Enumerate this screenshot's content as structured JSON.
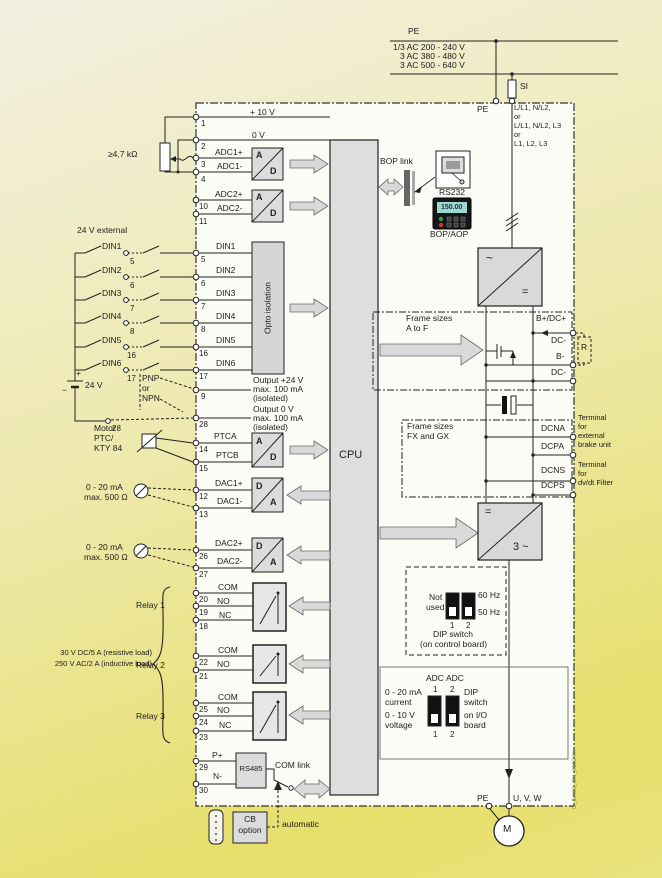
{
  "colors": {
    "bg_top": "#f2f0e2",
    "bg_bottom": "#e6df6b",
    "panel": "#fcfcf7",
    "box_gray": "#dcdcdc",
    "display_teal": "#9fd8d2",
    "led_green": "#35a043",
    "led_red": "#cf3333"
  },
  "mains": {
    "pe": "PE",
    "v1": "1/3 AC 200 - 240 V",
    "v2": "3 AC 380 - 480 V",
    "v3": "3 AC 500 - 640 V",
    "fuse": "SI"
  },
  "inputs": {
    "pe": "PE",
    "l1": "L/L1, N/L2,",
    "or1": "or",
    "l2": "L/L1, N/L2, L3",
    "or2": "or",
    "l3": "L1, L2, L3"
  },
  "analog": {
    "p10": "+ 10 V",
    "v0": "0 V",
    "pot": "≥4,7 kΩ",
    "adc1p": "ADC1+",
    "adc1m": "ADC1-",
    "adc2p": "ADC2+",
    "adc2m": "ADC2-"
  },
  "conv": {
    "a": "A",
    "d": "D"
  },
  "cpu": "CPU",
  "opto": "Opto isolation",
  "din": {
    "ext": "24 V  external",
    "d1": "DIN1",
    "d2": "DIN2",
    "d3": "DIN3",
    "d4": "DIN4",
    "d5": "DIN5",
    "d6": "DIN6",
    "pnp": "PNP",
    "or": "or",
    "npn": "NPN",
    "batt": "24 V",
    "plus": "+",
    "minus": "−"
  },
  "out": {
    "p24": "Output +24 V",
    "p0": "Output 0 V",
    "max": "max. 100 mA",
    "iso": "(isolated)"
  },
  "ptc": {
    "l1": "Motor",
    "l2": "PTC/",
    "l3": "KTY 84",
    "a": "PTCA",
    "b": "PTCB"
  },
  "dac": {
    "range": "0 - 20 mA",
    "load": "max. 500 Ω",
    "d1p": "DAC1+",
    "d1m": "DAC1-",
    "d2p": "DAC2+",
    "d2m": "DAC2-"
  },
  "relay": {
    "com": "COM",
    "no": "NO",
    "nc": "NC",
    "r1": "Relay 1",
    "r2": "Relay 2",
    "r3": "Relay 3",
    "load1": "30 V DC/5 A (resistive load)",
    "load2": "250 V AC/2 A (inductive load)"
  },
  "comm": {
    "bop_link": "BOP link",
    "rs232": "RS232",
    "bop_aop": "BOP/AOP",
    "display": "150.00",
    "rs485": "RS485",
    "com_link": "COM link",
    "pp": "P+",
    "nm": "N-",
    "cb1": "CB",
    "cb2": "option",
    "auto": "automatic"
  },
  "power": {
    "rect_in": "~",
    "rect_out": "=",
    "inv_in": "=",
    "inv_out": "3 ~",
    "af1": "Frame sizes",
    "af2": "A to F",
    "fx1": "Frame sizes",
    "fx2": "FX and GX",
    "bdc": "B+/DC+",
    "dc1": "DC-",
    "bm": "B-",
    "dc2": "DC-",
    "r": "R",
    "dcna": "DCNA",
    "dcpa": "DCPA",
    "dcns": "DCNS",
    "dcps": "DCPS",
    "brake": [
      "Terminal",
      "for",
      "external",
      "brake unit"
    ],
    "dvdt": [
      "Terminal",
      "for",
      "dv/dt Filter"
    ]
  },
  "dip1": {
    "n1": "Not",
    "n2": "used",
    "hz60": "60 Hz",
    "hz50": "50 Hz",
    "s1": "1",
    "s2": "2",
    "c1": "DIP switch",
    "c2": "(on control board)"
  },
  "dip2": {
    "adc": "ADC",
    "n1": "1",
    "n2": "2",
    "cur1": "0 - 20 mA",
    "cur2": "current",
    "v1": "0 - 10 V",
    "v2": "voltage",
    "t1": "DIP",
    "t2": "switch",
    "t3": "on I/O",
    "t4": "board"
  },
  "motor": {
    "pe": "PE",
    "uvw": "U, V, W",
    "m": "M"
  },
  "pins": {
    "p1": "1",
    "p2": "2",
    "p3": "3",
    "p4": "4",
    "p5": "5",
    "p6": "6",
    "p7": "7",
    "p8": "8",
    "p9": "9",
    "p10": "10",
    "p11": "11",
    "p12": "12",
    "p13": "13",
    "p14": "14",
    "p15": "15",
    "p16": "16",
    "p17": "17",
    "p18": "18",
    "p19": "19",
    "p20": "20",
    "p21": "21",
    "p22": "22",
    "p23": "23",
    "p24": "24",
    "p25": "25",
    "p26": "26",
    "p27": "27",
    "p28": "28",
    "p29": "29",
    "p30": "30"
  },
  "watermark": "G_DA51_EN_05024h"
}
